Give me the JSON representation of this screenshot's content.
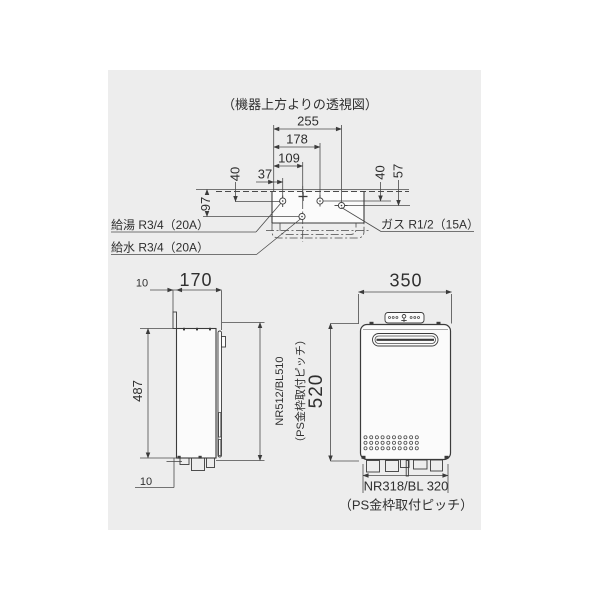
{
  "drawing": {
    "title": "（機器上方よりの透視図）",
    "top_view": {
      "dim_255": "255",
      "dim_178": "178",
      "dim_109": "109",
      "dim_37": "37",
      "dim_40_left": "40",
      "dim_97": "97",
      "dim_40_right": "40",
      "dim_57": "57",
      "label_hot_water": "給湯 R3/4（20A）",
      "label_cold_water": "給水 R3/4（20A）",
      "label_gas": "ガス R1/2（15A）"
    },
    "side_view": {
      "dim_10_top": "10",
      "dim_170": "170",
      "dim_487": "487",
      "dim_10_bottom": "10",
      "mount_pitch": "NR512/BL510",
      "mount_pitch_note": "（PS金枠取付ピッチ）"
    },
    "front_view": {
      "dim_350": "350",
      "dim_520": "520",
      "mount_pitch": "NR318/BL 320",
      "mount_pitch_note": "（PS金枠取付ピッチ）"
    },
    "colors": {
      "page": "#ffffff",
      "panel": "#ededed",
      "line": "#3b3b3b",
      "text": "#2f2f2f"
    }
  }
}
